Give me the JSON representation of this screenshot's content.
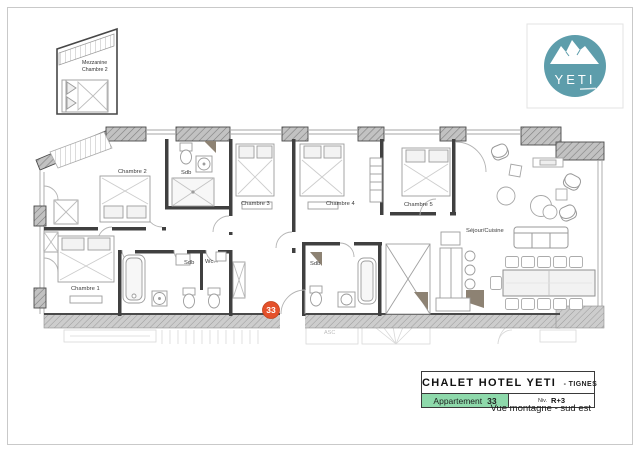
{
  "logo": {
    "text": "YETI",
    "circle_color": "#5d9dab"
  },
  "mezzanine_inset": {
    "line1": "Mezzanine",
    "line2": "Chambre 2"
  },
  "plan": {
    "labels": {
      "chambre1": "Chambre 1",
      "chambre2": "Chambre 2",
      "chambre3": "Chambre 3",
      "chambre4": "Chambre 4",
      "chambre5": "Chambre 5",
      "sejour": "Séjour/Cuisine",
      "sdb_top": "Sdb",
      "sdb_mid": "Sdb",
      "wc": "Wc.",
      "sdb_right": "Sdb",
      "asc": "ASC"
    },
    "unit_badge": {
      "number": "33",
      "color": "#e4512b"
    }
  },
  "title_block": {
    "title": "CHALET HOTEL YETI",
    "title_suffix": "- TIGNES",
    "apartment_label": "Appartement",
    "apartment_number": "33",
    "level_label": "Niv.",
    "level_value": "R+3",
    "view_caption": "Vue montagne - sud est",
    "highlight_color": "#8ed9ab"
  }
}
